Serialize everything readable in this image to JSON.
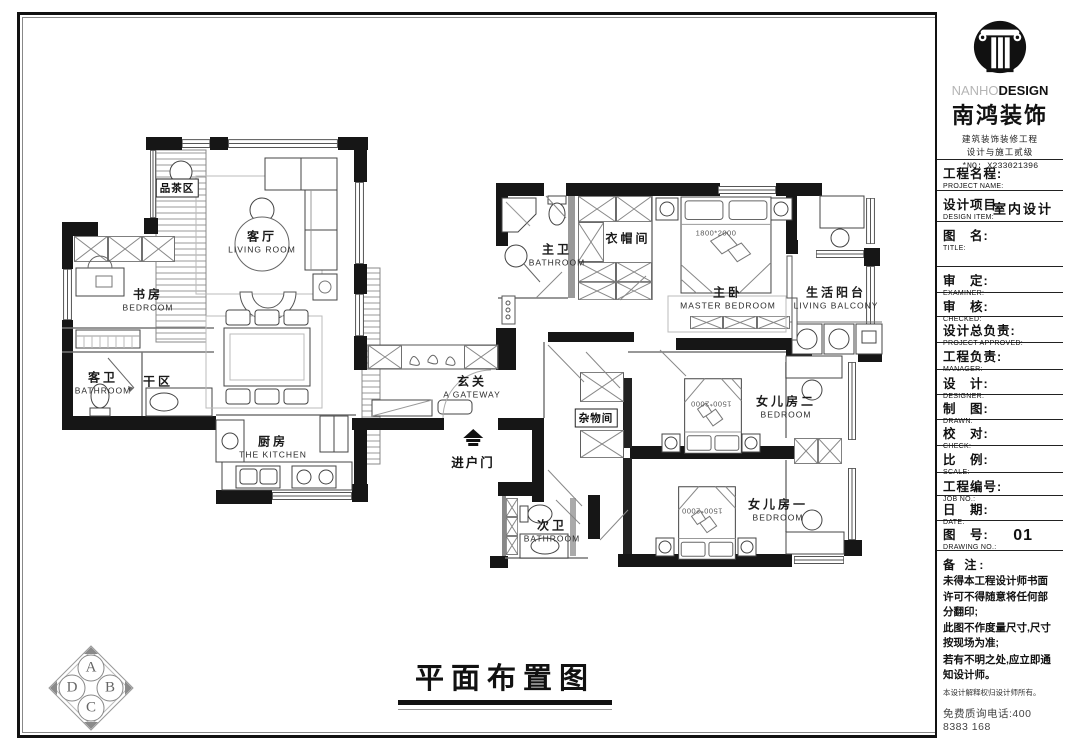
{
  "sheet": {
    "drawing_title": "平面布置图",
    "compass": {
      "a": "A",
      "b": "B",
      "c": "C",
      "d": "D"
    }
  },
  "brand": {
    "en_light": "NANHO",
    "en_bold": "DESIGN",
    "cn": "南鸿装饰",
    "cert1": "建筑装饰装修工程",
    "cert2": "设计与施工贰级",
    "license": "*NO: X233021396"
  },
  "titleblock": {
    "rows": [
      {
        "cn": "工程名程:",
        "en": "PROJECT NAME:",
        "value": ""
      },
      {
        "cn": "设计项目:",
        "en": "DESIGN ITEM:",
        "value": "室内设计"
      },
      {
        "cn": "图　名:",
        "en": "TITLE:",
        "value": ""
      },
      {
        "cn": "审　定:",
        "en": "EXAMINER:",
        "value": ""
      },
      {
        "cn": "审　核:",
        "en": "CHECKED:",
        "value": ""
      },
      {
        "cn": "设计总负责:",
        "en": "PROJECT APPROVED:",
        "value": ""
      },
      {
        "cn": "工程负责:",
        "en": "MANAGER:",
        "value": ""
      },
      {
        "cn": "设　计:",
        "en": "DESIGNER:",
        "value": ""
      },
      {
        "cn": "制　图:",
        "en": "DRAWN:",
        "value": ""
      },
      {
        "cn": "校　对:",
        "en": "CHECK:",
        "value": ""
      },
      {
        "cn": "比　例:",
        "en": "SCALE:",
        "value": ""
      },
      {
        "cn": "工程编号:",
        "en": "JOB NO.:",
        "value": ""
      },
      {
        "cn": "日　期:",
        "en": "DATE:",
        "value": ""
      },
      {
        "cn": "图　号:",
        "en": "DRAWING NO.:",
        "value": "01"
      }
    ],
    "notes_title": "备 注:",
    "notes": [
      "未得本工程设计师书面许可不得随意将任何部分翻印;",
      "此图不作度量尺寸,尺寸按现场为准;",
      "若有不明之处,应立即通知设计师。"
    ],
    "disclaimer": "本设计解释权归设计师所有。",
    "hotline": "免费质询电话:400 8383 168"
  },
  "rooms": [
    {
      "cn": "品茶区",
      "en": ""
    },
    {
      "cn": "客厅",
      "en": "LIVING ROOM"
    },
    {
      "cn": "书房",
      "en": "BEDROOM"
    },
    {
      "cn": "客卫",
      "en": "BATHROOM"
    },
    {
      "cn": "干区",
      "en": ""
    },
    {
      "cn": "厨房",
      "en": "THE KITCHEN"
    },
    {
      "cn": "玄关",
      "en": "A GATEWAY"
    },
    {
      "cn": "主卫",
      "en": "BATHROOM"
    },
    {
      "cn": "衣帽间",
      "en": ""
    },
    {
      "cn": "主卧",
      "en": "MASTER BEDROOM"
    },
    {
      "cn": "生活阳台",
      "en": "LIVING BALCONY"
    },
    {
      "cn": "杂物间",
      "en": ""
    },
    {
      "cn": "女儿房二",
      "en": "BEDROOM"
    },
    {
      "cn": "女儿房一",
      "en": "BEDROOM"
    },
    {
      "cn": "次卫",
      "en": "BATHROOM"
    }
  ],
  "annotations": {
    "entry": "进户门",
    "master_bed_size": "1800*2000",
    "girl_bed_size": "1500*2000"
  }
}
